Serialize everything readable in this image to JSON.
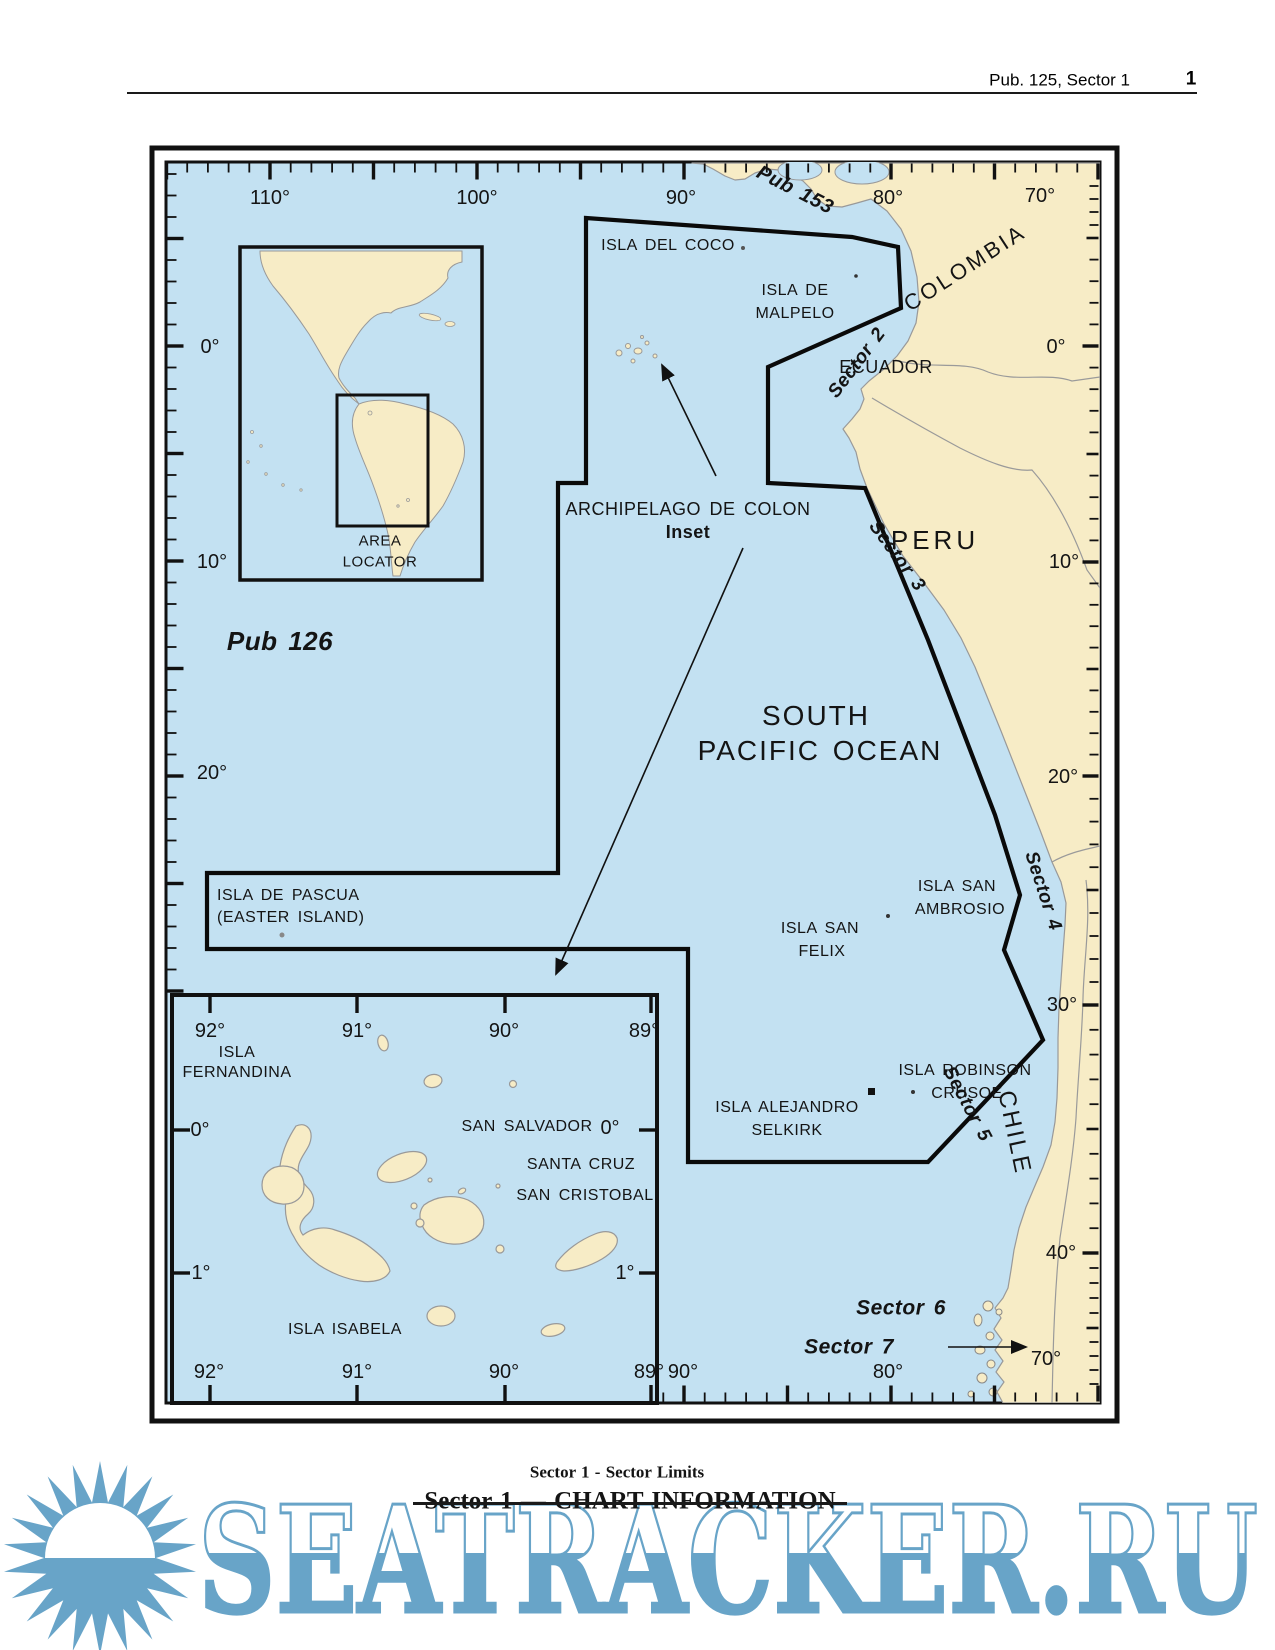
{
  "header": {
    "publication": "Pub. 125, Sector 1",
    "page_number": "1"
  },
  "map": {
    "top_lon": [
      "110°",
      "100°",
      "90°",
      "80°",
      "70°"
    ],
    "left_lat": [
      "0°",
      "10°",
      "20°"
    ],
    "right_lat": [
      "0°",
      "10°",
      "20°",
      "30°",
      "40°"
    ],
    "bottom_lon": [
      "90°",
      "80°",
      "70°"
    ],
    "pub_153": "Pub 153",
    "pub_126": "Pub 126",
    "sector_2": "Sector 2",
    "sector_3": "Sector 3",
    "sector_4": "Sector 4",
    "sector_5": "Sector 5",
    "sector_6": "Sector 6",
    "sector_7": "Sector 7",
    "colombia": "COLOMBIA",
    "ecuador": "ECUADOR",
    "peru": "PERU",
    "chile": "CHILE",
    "ocean_line1": "SOUTH",
    "ocean_line2": "PACIFIC OCEAN",
    "isla_del_coco": "ISLA DEL COCO",
    "isla_de_malpelo_1": "ISLA DE",
    "isla_de_malpelo_2": "MALPELO",
    "archipelago_title": "ARCHIPELAGO DE COLON",
    "archipelago_subtitle": "Inset",
    "area_locator_1": "AREA",
    "area_locator_2": "LOCATOR",
    "isla_de_pascua_1": "ISLA DE PASCUA",
    "isla_de_pascua_2": "(EASTER ISLAND)",
    "isla_san_ambrosio_1": "ISLA SAN",
    "isla_san_ambrosio_2": "AMBROSIO",
    "isla_san_felix_1": "ISLA SAN",
    "isla_san_felix_2": "FELIX",
    "isla_robinson_1": "ISLA ROBINSON",
    "isla_robinson_2": "CRUSOE",
    "isla_alejandro_1": "ISLA ALEJANDRO",
    "isla_alejandro_2": "SELKIRK"
  },
  "inset": {
    "lon": [
      "92°",
      "91°",
      "90°",
      "89°"
    ],
    "lat": [
      "0°",
      "1°"
    ],
    "isla_fernandina_1": "ISLA",
    "isla_fernandina_2": "FERNANDINA",
    "san_salvador": "SAN SALVADOR",
    "santa_cruz": "SANTA CRUZ",
    "san_cristobal": "SAN CRISTOBAL",
    "isla_isabela": "ISLA ISABELA"
  },
  "caption": {
    "line1": "Sector 1 - Sector Limits",
    "line2": "Sector 1 — CHART INFORMATION"
  },
  "watermark": {
    "text": "SEATRACKER.RU"
  },
  "colors": {
    "ocean": "#c3e1f2",
    "land": "#f7ecc6",
    "line": "#111111",
    "watermark": "#68a4c8"
  }
}
